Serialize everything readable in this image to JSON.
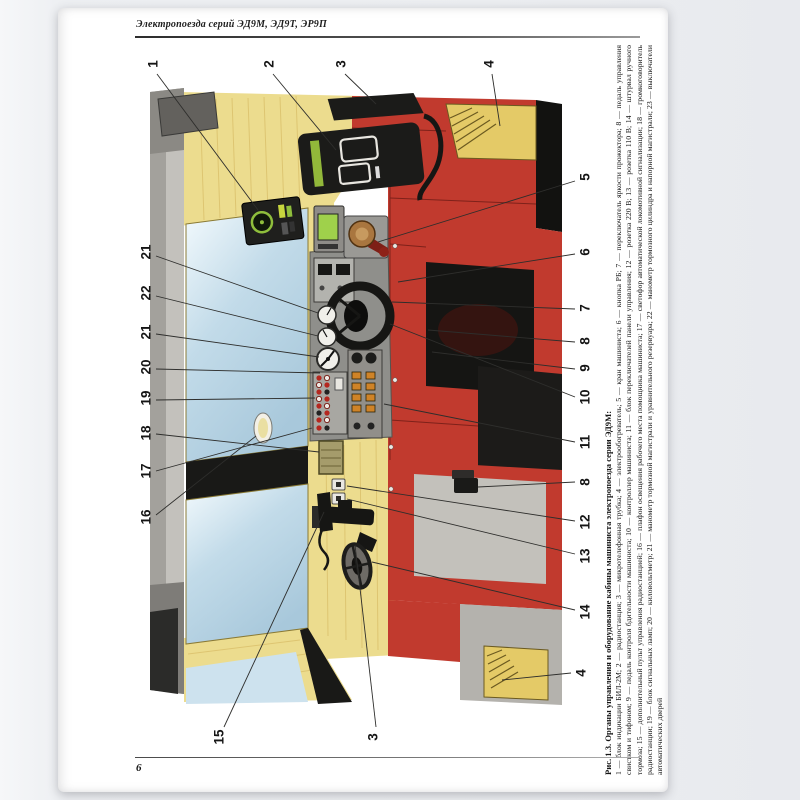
{
  "page": {
    "running_header": "Электропоезда серий ЭД9М, ЭД9Т, ЭР9П",
    "page_number": "6"
  },
  "figure": {
    "caption_title": "Рис. 1.3. Органы управления и оборудование кабины машиниста электропоезда серии ЭД9М:",
    "caption_body": "1 — блок индикации БИЛ-2М; 2 — радиостанция; 3 — микротелефонная трубка; 4 — электрообогреватель; 5 — кран машиниста; 6 — кнопка РБ; 7 — переключатель яркости прожектора; 8 — педаль управления свистком и тифоном; 9 — педаль контроля бдительности машиниста; 10 — контроллер машиниста; 11 — блок переключателей панели управления; 12 — розетка 220 В; 13 — розетка 110 В; 14 — штурвал ручного тормоза; 15 — дополнительный пульт управления радиостанцией; 16 — плафон освещения рабочего места помощника машиниста; 17 — светофор автоматической локомотивной сигнализации; 18 — громкоговоритель радиостанции; 19 — блок сигнальных ламп; 20 — киловольтметр; 21 — манометр тормозной магистрали и уравнительного резервуара; 22 — манометр тормозного цилиндра и напорной магистрали; 23 — выключатели автоматических дверей",
    "callouts": [
      {
        "label": "1",
        "x": 153,
        "y": 64,
        "x1": 157,
        "y1": 74,
        "x2": 258,
        "y2": 210
      },
      {
        "label": "2",
        "x": 269,
        "y": 64,
        "x1": 273,
        "y1": 74,
        "x2": 336,
        "y2": 150
      },
      {
        "label": "3",
        "x": 341,
        "y": 64,
        "x1": 345,
        "y1": 74,
        "x2": 376,
        "y2": 104
      },
      {
        "label": "4",
        "x": 489,
        "y": 64,
        "x1": 492,
        "y1": 74,
        "x2": 500,
        "y2": 126
      },
      {
        "label": "21",
        "x": 146,
        "y": 252,
        "x1": 156,
        "y1": 256,
        "x2": 318,
        "y2": 313
      },
      {
        "label": "22",
        "x": 146,
        "y": 293,
        "x1": 156,
        "y1": 296,
        "x2": 318,
        "y2": 336
      },
      {
        "label": "21",
        "x": 146,
        "y": 332,
        "x1": 156,
        "y1": 334,
        "x2": 319,
        "y2": 357
      },
      {
        "label": "20",
        "x": 146,
        "y": 367,
        "x1": 156,
        "y1": 369,
        "x2": 320,
        "y2": 373
      },
      {
        "label": "19",
        "x": 146,
        "y": 398,
        "x1": 156,
        "y1": 400,
        "x2": 315,
        "y2": 398
      },
      {
        "label": "18",
        "x": 146,
        "y": 433,
        "x1": 156,
        "y1": 434,
        "x2": 319,
        "y2": 452
      },
      {
        "label": "17",
        "x": 146,
        "y": 471,
        "x1": 156,
        "y1": 471,
        "x2": 312,
        "y2": 428
      },
      {
        "label": "16",
        "x": 146,
        "y": 517,
        "x1": 156,
        "y1": 515,
        "x2": 256,
        "y2": 436
      },
      {
        "label": "5",
        "x": 585,
        "y": 177,
        "x1": 575,
        "y1": 181,
        "x2": 378,
        "y2": 242
      },
      {
        "label": "6",
        "x": 585,
        "y": 252,
        "x1": 575,
        "y1": 254,
        "x2": 398,
        "y2": 282
      },
      {
        "label": "7",
        "x": 585,
        "y": 308,
        "x1": 575,
        "y1": 309,
        "x2": 392,
        "y2": 302
      },
      {
        "label": "8",
        "x": 585,
        "y": 341,
        "x1": 575,
        "y1": 342,
        "x2": 428,
        "y2": 330
      },
      {
        "label": "9",
        "x": 585,
        "y": 368,
        "x1": 575,
        "y1": 369,
        "x2": 432,
        "y2": 352
      },
      {
        "label": "10",
        "x": 585,
        "y": 397,
        "x1": 575,
        "y1": 397,
        "x2": 390,
        "y2": 324
      },
      {
        "label": "11",
        "x": 585,
        "y": 442,
        "x1": 575,
        "y1": 442,
        "x2": 384,
        "y2": 404
      },
      {
        "label": "8",
        "x": 585,
        "y": 482,
        "x1": 575,
        "y1": 482,
        "x2": 478,
        "y2": 487
      },
      {
        "label": "12",
        "x": 585,
        "y": 522,
        "x1": 575,
        "y1": 521,
        "x2": 347,
        "y2": 486
      },
      {
        "label": "13",
        "x": 585,
        "y": 556,
        "x1": 575,
        "y1": 554,
        "x2": 347,
        "y2": 499
      },
      {
        "label": "14",
        "x": 585,
        "y": 612,
        "x1": 575,
        "y1": 610,
        "x2": 372,
        "y2": 562
      },
      {
        "label": "15",
        "x": 219,
        "y": 737,
        "x1": 224,
        "y1": 727,
        "x2": 324,
        "y2": 512
      },
      {
        "label": "3",
        "x": 373,
        "y": 737,
        "x1": 376,
        "y1": 727,
        "x2": 355,
        "y2": 545
      },
      {
        "label": "4",
        "x": 581,
        "y": 673,
        "x1": 571,
        "y1": 673,
        "x2": 502,
        "y2": 680
      }
    ]
  },
  "colors": {
    "cabinet_red": "#c13a2e",
    "wall_yellow": "#ecdc8e",
    "window_blue": "#c2dbe9",
    "heater_yellow": "#e4ca67",
    "desk_gray": "#8f8f8b",
    "toggle_amber": "#cf8327",
    "display_green": "#8fbe3c",
    "floor_gray": "#b4b2ad"
  }
}
